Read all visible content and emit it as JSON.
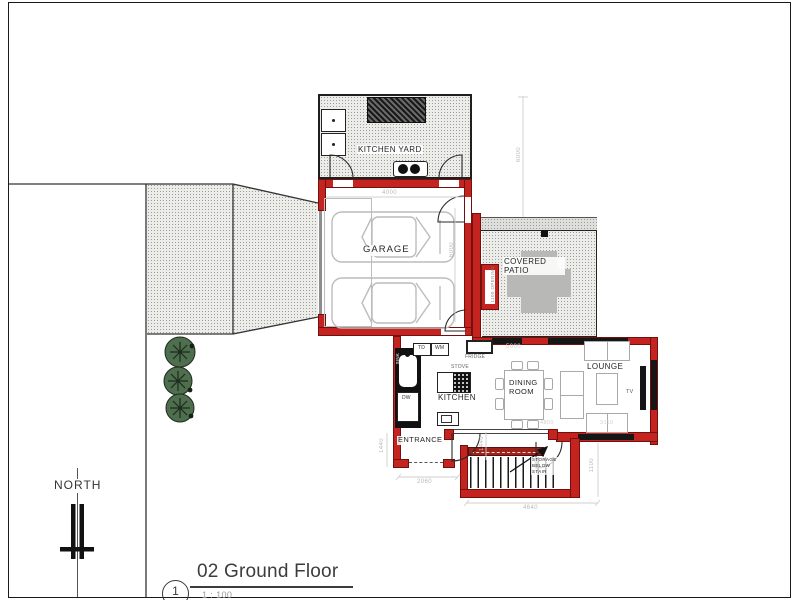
{
  "sheet": {
    "title": "02 Ground Floor",
    "number": "1",
    "scale": "1 : 100",
    "north": "NORTH"
  },
  "rooms": {
    "kitchen_yard": "KITCHEN YARD",
    "garage": "GARAGE",
    "covered_patio_1": "COVERED",
    "covered_patio_2": "PATIO",
    "kitchen": "KITCHEN",
    "dining_1": "DINING",
    "dining_2": "ROOM",
    "lounge": "LOUNGE",
    "entrance": "ENTRANCE"
  },
  "fixtures": {
    "td": "TD",
    "wm": "WM",
    "sink": "SINK",
    "fridge": "FRIDGE",
    "stove": "STOVE",
    "dw": "DW",
    "tv": "TV",
    "stair_note_1": "STORAGE",
    "stair_note_2": "BELOW",
    "stair_note_3": "STAIR",
    "patio_opening": "1100 OPENING"
  },
  "dimensions": {
    "yard_width": "4000",
    "yard_height": "6000",
    "garage_width": "4000",
    "garage_depth": "6000",
    "dining_width": "5000",
    "entrance_height": "1440",
    "entrance_width": "2060",
    "hall_height": "1440",
    "dining_bottom": "4800",
    "lounge_width": "3110",
    "stair_width": "4640",
    "stair_height": "1100"
  },
  "colors": {
    "wall_red": "#c4231f",
    "hatch_dot": "#9b9b9b",
    "dim_gray": "#bdbdbd",
    "tree_green": "#4e6e4e"
  }
}
